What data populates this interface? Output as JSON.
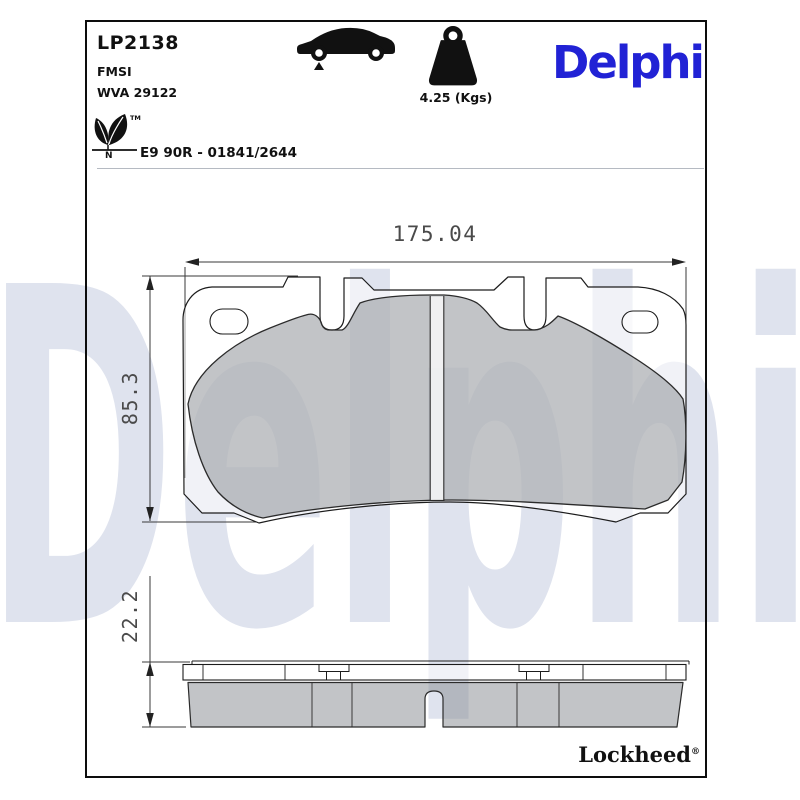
{
  "header": {
    "part_number": "LP2138",
    "fmsi_label": "FMSI",
    "wva_label": "WVA 29122",
    "weight_label": "4.25 (Kgs)",
    "brand": "Delphi",
    "brand_color": "#2122d5",
    "approval_text": "E9 90R - 01841/2644",
    "leaf_tm": "TM",
    "leaf_n": "N"
  },
  "watermark": {
    "text": "Delphi",
    "color": "#dfe3ee"
  },
  "drawing": {
    "dim_width": "175.04",
    "dim_height": "85.3",
    "dim_thickness": "22.2",
    "pad_fill": "rgba(138,142,148,0.52)",
    "line_color": "#1c1c1c"
  },
  "footer": {
    "brand": "Lockheed",
    "registered": "®"
  }
}
